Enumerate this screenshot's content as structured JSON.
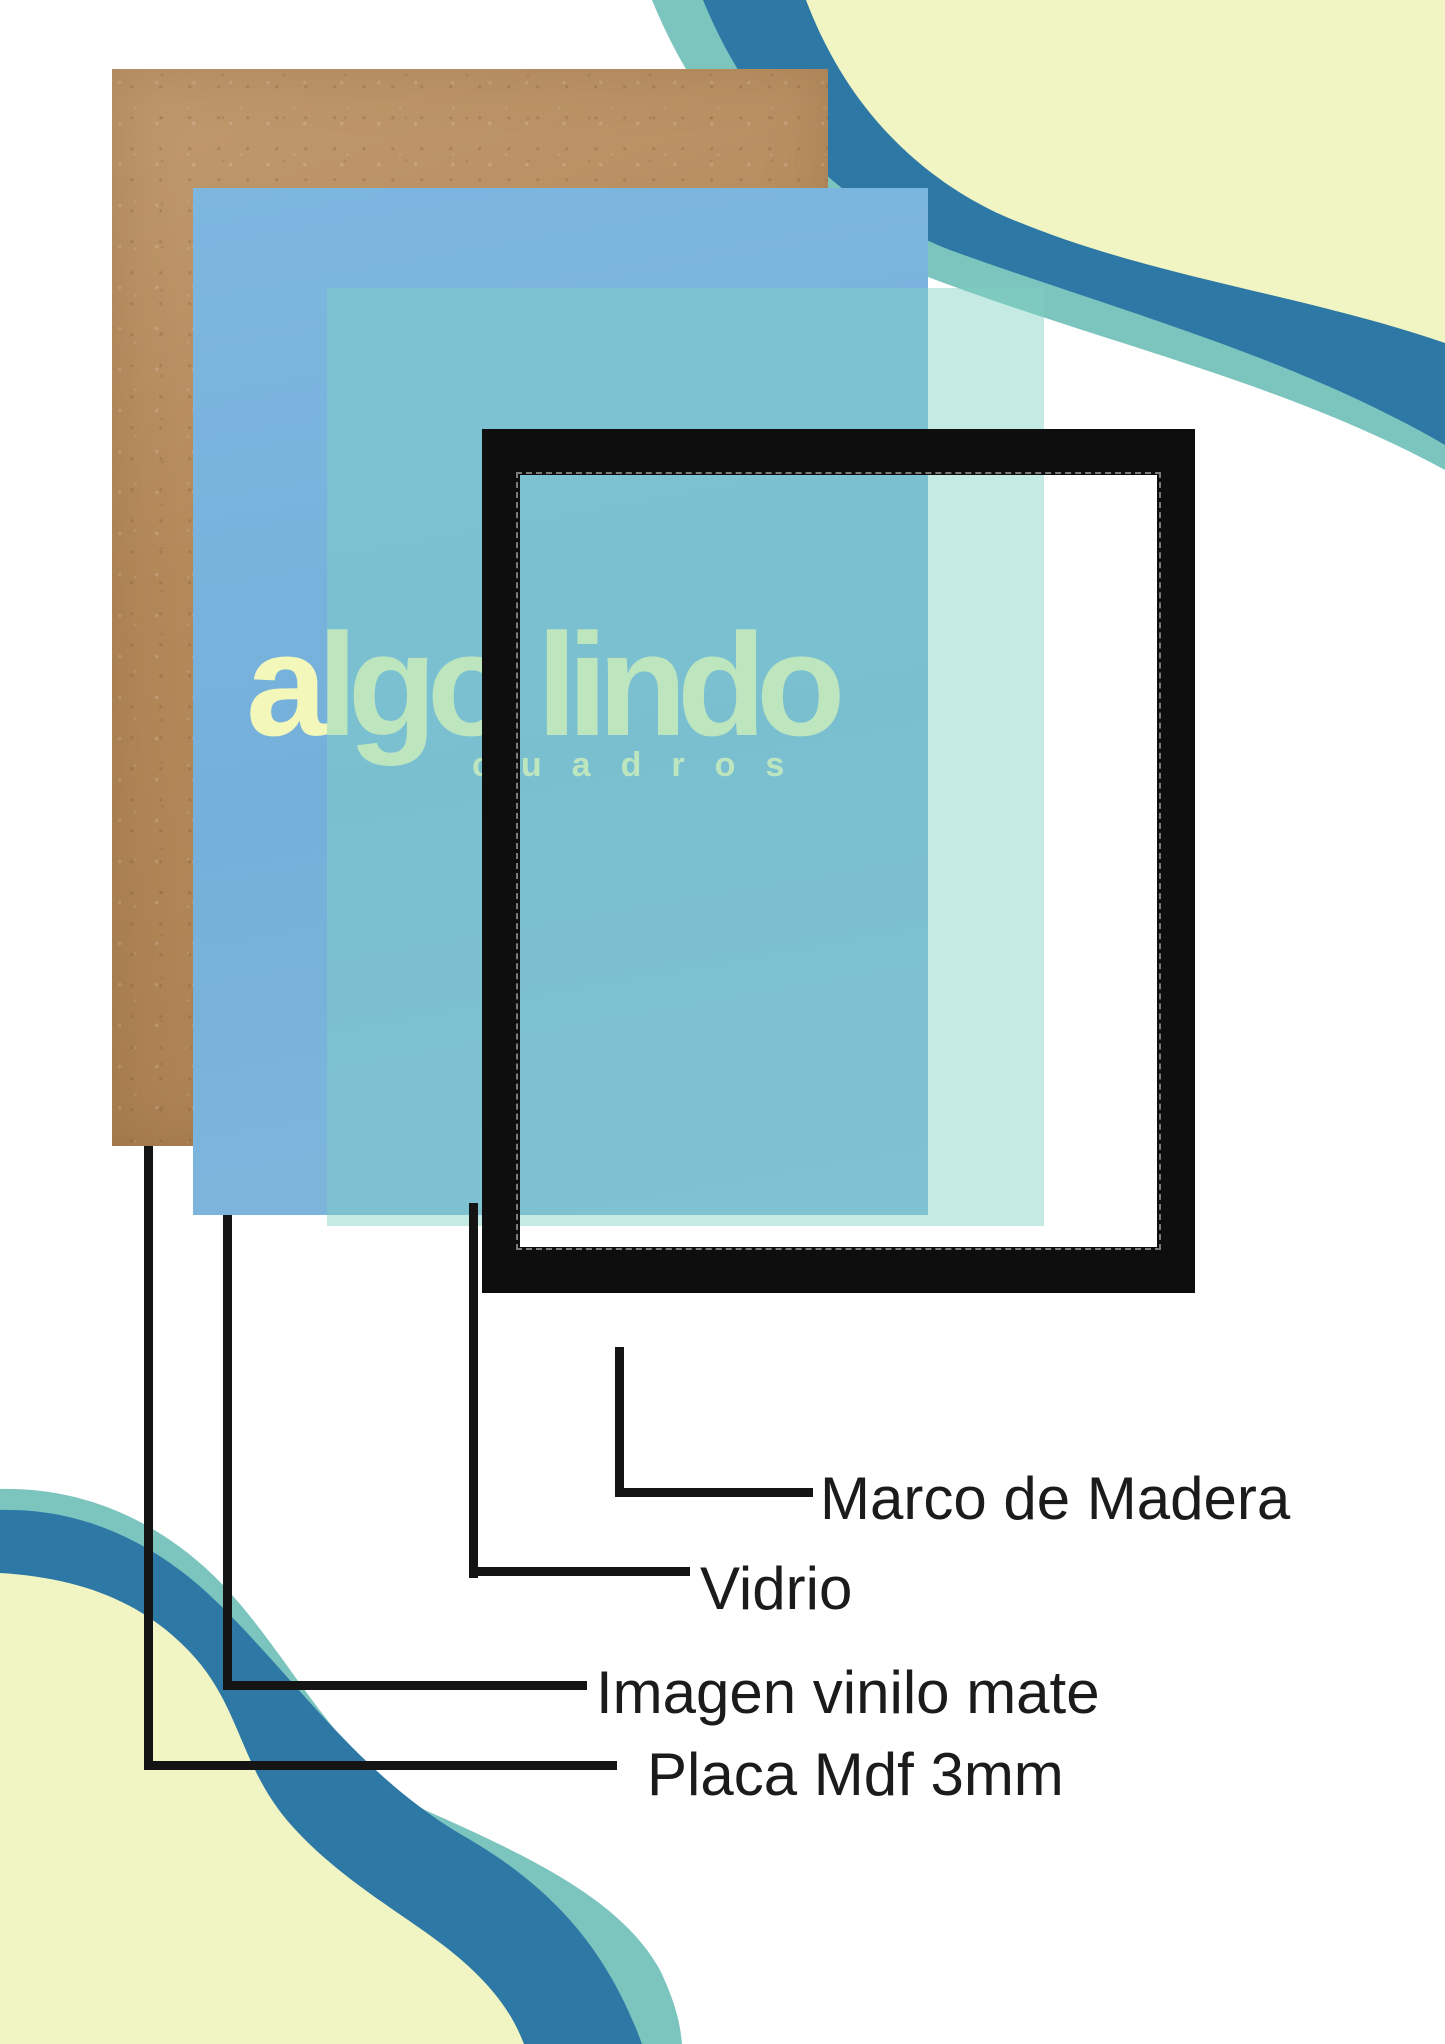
{
  "brand": {
    "wordmark": "algo lindo",
    "subtext": "cuadros"
  },
  "callouts": {
    "marco": {
      "label": "Marco de Madera"
    },
    "vidrio": {
      "label": "Vidrio"
    },
    "imagen": {
      "label": "Imagen vinilo mate"
    },
    "placa": {
      "label": "Placa Mdf 3mm"
    }
  },
  "colors": {
    "kraft": "#b4895a",
    "vinyl-blue": "#79b3dc",
    "glass-teal": "#80d1c5",
    "frame-black": "#0e0e0e",
    "line-black": "#141414",
    "label-color": "#1b1b1b",
    "wave-yellow": "#f0f5c3",
    "wave-steel": "#2e78a6",
    "wave-teal": "#7cc5bf",
    "wordmark-yellow": "#f3f7ba"
  }
}
